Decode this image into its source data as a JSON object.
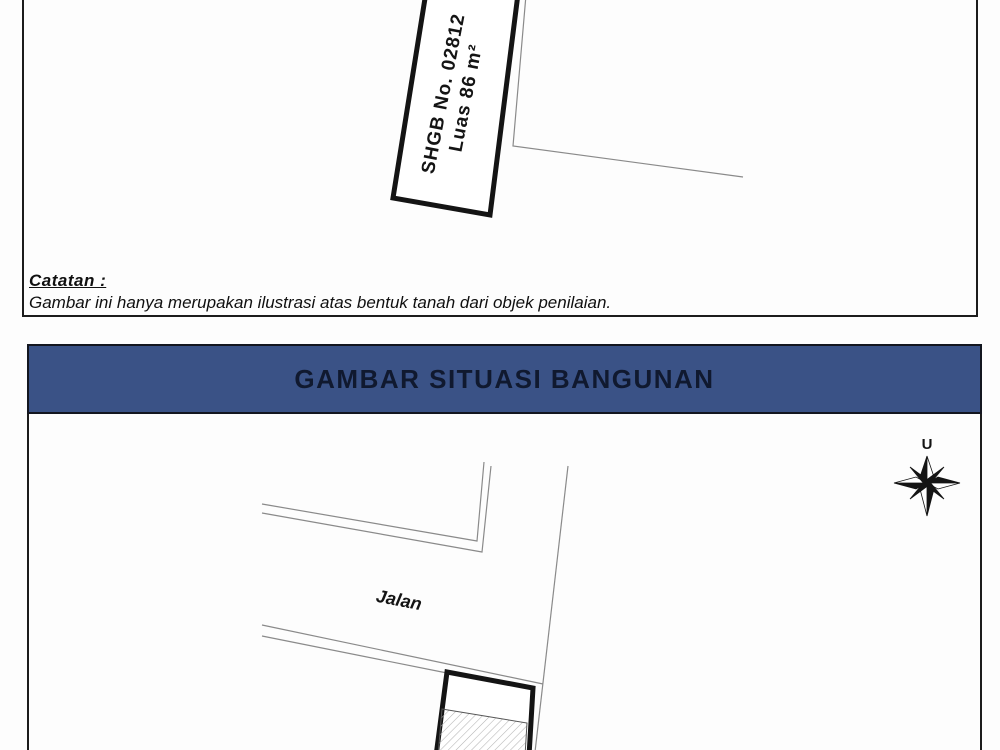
{
  "land_figure": {
    "parcel_label_line1": "SHGB No. 02812",
    "parcel_label_line2": "Luas 86 m²",
    "note_title": "Catatan :",
    "note_body": "Gambar ini hanya merupakan ilustrasi atas bentuk tanah dari objek penilaian."
  },
  "building_figure": {
    "title": "GAMBAR SITUASI BANGUNAN",
    "road_label": "Jalan",
    "compass_north_label": "U"
  },
  "colors": {
    "header_bg": "#3a5286",
    "header_text": "#10192f",
    "outline_thick": "#141414",
    "boundary_thin": "#8a8a8a",
    "hatch_line": "#b3b3b3"
  }
}
